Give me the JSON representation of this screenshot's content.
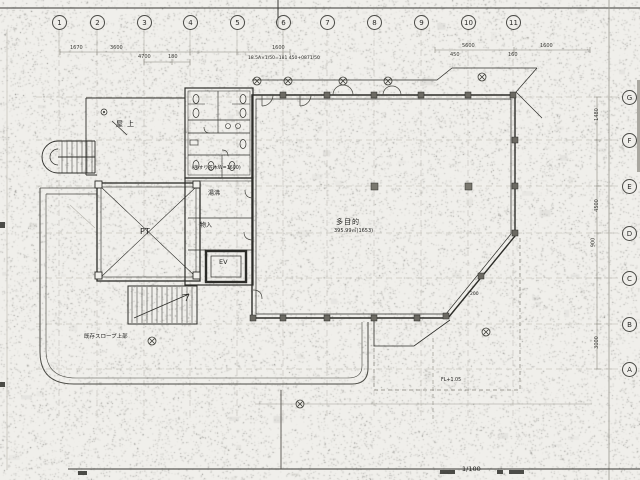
{
  "sheet": {
    "scale_label": "1/100"
  },
  "grid": {
    "columns": [
      "1",
      "2",
      "3",
      "4",
      "5",
      "6",
      "7",
      "8",
      "9",
      "10",
      "11"
    ],
    "rows": [
      "G",
      "F",
      "E",
      "D",
      "C",
      "B",
      "A"
    ]
  },
  "rooms": {
    "rooftop": "屋上",
    "shaft": "PT",
    "kitchenette": "湯沸",
    "storage": "物入",
    "elevator": "EV",
    "hall": "多目的",
    "hall_area": "395.99㎡(1653)"
  },
  "annotations": {
    "existing_slope": "既存スロープ上部",
    "handrail_note": "(手すり笠木W=1600)",
    "calc_note": "18.5A×1/50=181 450+0871/50",
    "level_note": "FL+1.05",
    "step_note": "200"
  },
  "dimensions": {
    "top": [
      "1670",
      "3600",
      "4700",
      "180",
      "1600",
      "5600",
      "450",
      "160",
      "1600"
    ],
    "right": [
      "1480",
      "4500",
      "900",
      "3000"
    ]
  }
}
